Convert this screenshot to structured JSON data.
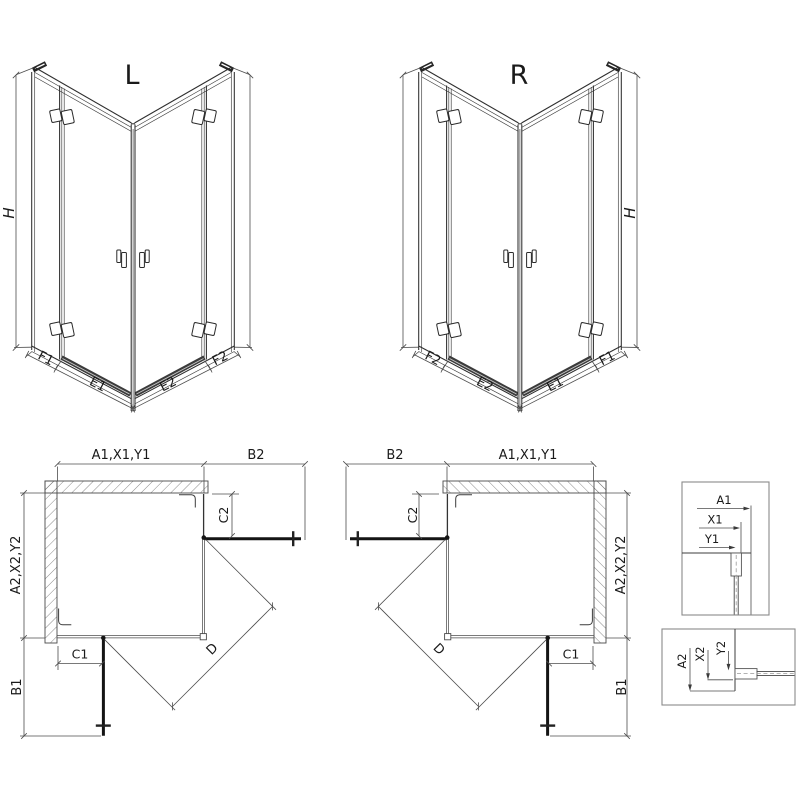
{
  "elevations": {
    "left": {
      "variant": "L",
      "height": "H",
      "bottom_left": [
        "F1",
        "E1"
      ],
      "bottom_right": [
        "E2",
        "F2"
      ]
    },
    "right": {
      "variant": "R",
      "height": "H",
      "bottom_left": [
        "F2",
        "E2"
      ],
      "bottom_right": [
        "E1",
        "F1"
      ]
    }
  },
  "plans": {
    "left": {
      "top_width": "A1,X1,Y1",
      "top_door": "B2",
      "side_depth": "A2,X2,Y2",
      "side_door": "B1",
      "fixed_top": "C2",
      "fixed_side": "C1",
      "diagonal": "D"
    },
    "right": {
      "top_width": "A1,X1,Y1",
      "top_door": "B2",
      "side_depth": "A2,X2,Y2",
      "side_door": "B1",
      "fixed_top": "C2",
      "fixed_side": "C1",
      "diagonal": "D"
    }
  },
  "details": {
    "wall_profile_vertical": {
      "dim_outer": "A1",
      "dim_mid": "X1",
      "dim_glass": "Y1"
    },
    "wall_profile_horizontal": {
      "dim_outer": "A2",
      "dim_mid": "X2",
      "dim_glass": "Y2"
    }
  },
  "colors": {
    "line": "#2e2e2e",
    "dim_line": "#4c4c4c",
    "door": "#141414",
    "background": "#ffffff"
  }
}
